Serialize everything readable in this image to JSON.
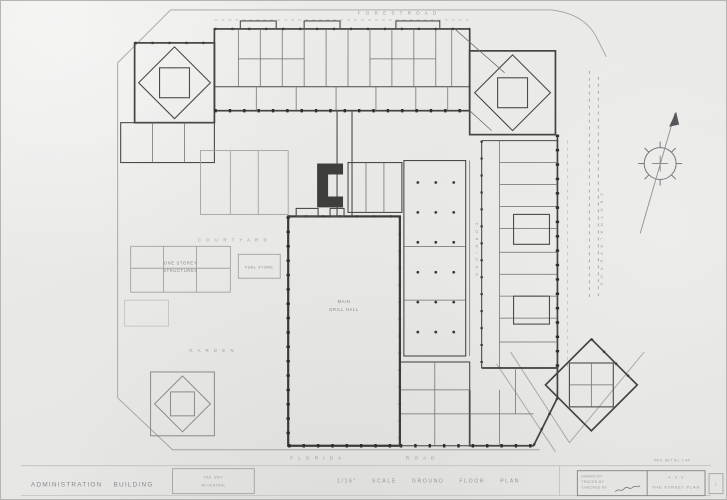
{
  "meta": {
    "paper_color": "#e9e9e7",
    "ink_color": "#3f3f3d",
    "light_line_color": "#a2a2a0"
  },
  "streets": {
    "top": "F O R E S T   R O A D",
    "right": "C E N T R A L   A V E N U E",
    "bottom_name": "F L O R I D A",
    "bottom_suffix": "R O A D"
  },
  "plan_labels": {
    "courtyard": "C O U R T Y A R D",
    "shed_line1": "ONE STOREY",
    "shed_line2": "STRUCTURES",
    "store": "FUEL STORE",
    "garden": "G A R D E N",
    "hall_line1": "MAIN",
    "hall_line2": "DRILL HALL",
    "corridor": "C O R R I D O R"
  },
  "bottom_bar": {
    "building_title": "ADMINISTRATION BUILDING",
    "stamp_line1": "CAP. UNIT",
    "stamp_line2": "4B CENTRAL",
    "scale_caption": "1/16\" SCALE GROUND FLOOR PLAN"
  },
  "title_block": {
    "above_note": "REV. SET No. 7-44",
    "row1": "DRAWN BY",
    "row2": "TRACED BY",
    "row3": "CHECKED BY",
    "marks_line": "- 4 - 5 - 3 -",
    "title_line": "THE STREET PLAN",
    "sheet_no": "1"
  }
}
